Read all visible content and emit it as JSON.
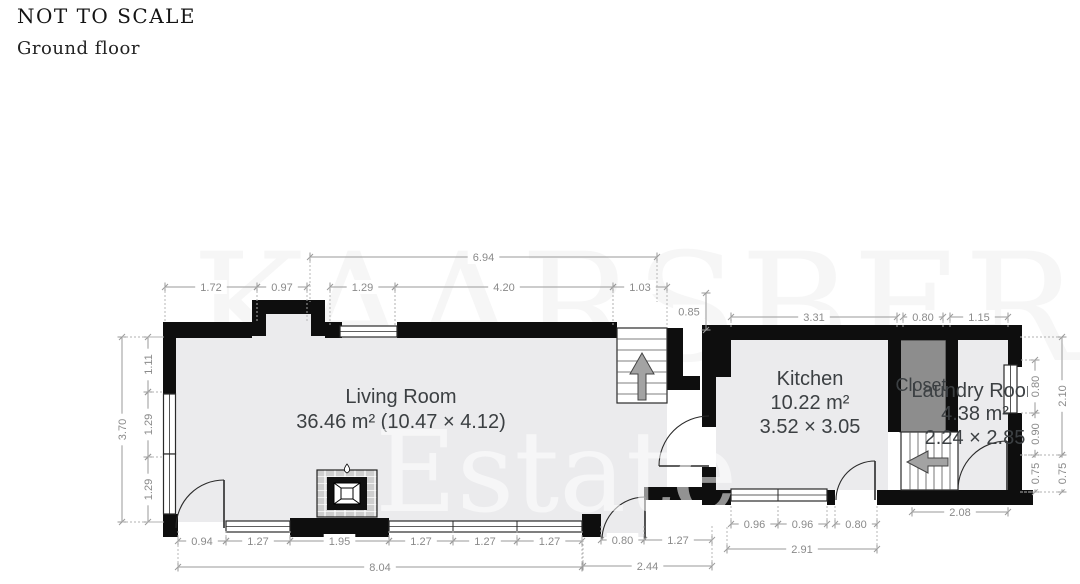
{
  "header": {
    "not_to_scale": "NOT TO SCALE",
    "floor_label": "Ground floor"
  },
  "watermark": {
    "line1": "KAARSBERG",
    "line2": "Estate"
  },
  "rooms": {
    "living": {
      "name": "Living Room",
      "area": "36.46 m² (10.47 × 4.12)"
    },
    "kitchen": {
      "name": "Kitchen",
      "area": "10.22 m²",
      "size": "3.52 × 3.05"
    },
    "closet": {
      "name": "Closet"
    },
    "laundry": {
      "name": "Laundry Room",
      "area": "4.38 m²",
      "size": "2.24 × 2.85"
    }
  },
  "icons": {
    "stairs_up_arrow": "arrow-up",
    "stairs_down_arrow": "arrow-left",
    "fireplace": "flame"
  },
  "colors": {
    "wall": "#0e0e0e",
    "floor": "#ebebed",
    "closet_fill": "#8d8d8d",
    "dim_line": "#9a9a9a",
    "dim_text": "#8a8a8a",
    "label_text": "#3c4043",
    "arrow_fill": "#a3a3a3",
    "outline": "#2a2a2a"
  },
  "dimensions": {
    "t1": "1.72",
    "t2": "0.97",
    "t3": "1.29",
    "t4": "4.20",
    "t5": "1.03",
    "t6": "6.94",
    "t7": "0.85",
    "k1": "3.31",
    "k2": "0.80",
    "k3": "1.15",
    "l1": "1.11",
    "l2": "1.29",
    "l3": "1.29",
    "l4": "3.70",
    "r1": "0.80",
    "r2": "0.90",
    "r3": "0.75",
    "r4": "2.10",
    "r5": "0.75",
    "b1": "0.94",
    "b2": "1.27",
    "b3": "1.95",
    "b4": "1.27",
    "b5": "1.27",
    "b6": "1.27",
    "b7": "8.04",
    "h1": "0.80",
    "h2": "1.27",
    "h3": "2.44",
    "kb1": "0.96",
    "kb2": "0.96",
    "kb3": "0.80",
    "kb4": "2.91",
    "lb1": "2.08"
  }
}
